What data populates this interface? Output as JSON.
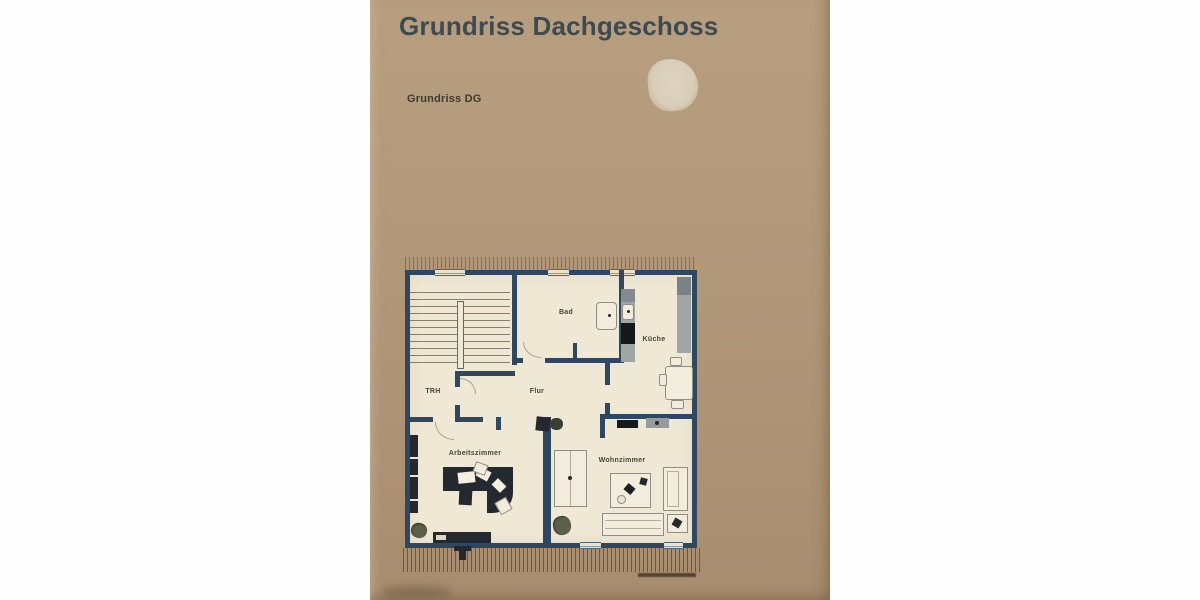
{
  "document": {
    "title": "Grundriss Dachgeschoss",
    "subtitle": "Grundriss DG"
  },
  "floorplan": {
    "rooms": [
      {
        "id": "trh",
        "label": "TRH"
      },
      {
        "id": "bad",
        "label": "Bad"
      },
      {
        "id": "kueche",
        "label": "Küche"
      },
      {
        "id": "flur",
        "label": "Flur"
      },
      {
        "id": "arbeitszimmer",
        "label": "Arbeitszimmer"
      },
      {
        "id": "wohnzimmer",
        "label": "Wohnzimmer"
      }
    ],
    "colors": {
      "page": "#b29877",
      "floor": "#efe8d5",
      "wall": "#2d4860",
      "furniture_dark": "#23292e",
      "counter_gray": "#a0a6a4",
      "plant_olive": "#5d6049",
      "title_text": "#3c4a52",
      "label_text": "#474338"
    }
  }
}
